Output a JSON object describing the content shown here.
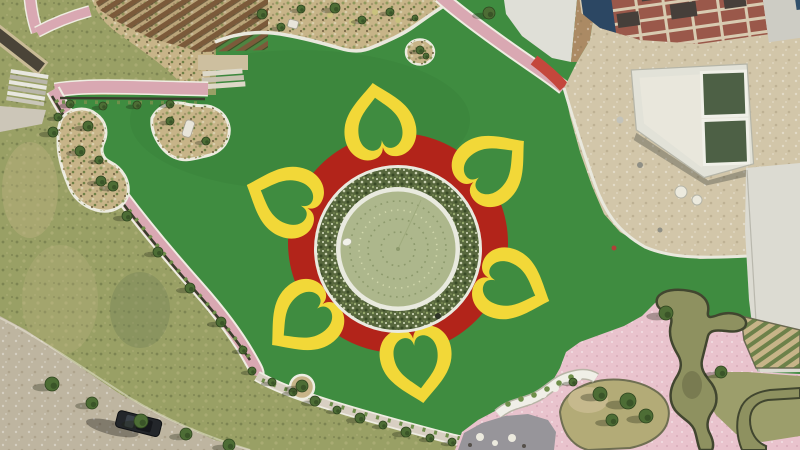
{
  "scene": {
    "title": "Aerial drone view of a park with flower-shaped fountain plaza",
    "regions": {
      "flower_plaza": "red circular plaza with six yellow heart-shaped petal outlines around a circular fountain pond with shrub ring",
      "lawn": "bright green turf lawn with organic tan planting islands",
      "construction_site": "sandy construction zone with brick-frame building and twin green water tanks (top right)",
      "water_garden": "pink paved garden with winding olive water channels and tree mound (bottom right)",
      "paths": "pink brick paths lined with hedges and young trees",
      "pergola_garden": "wooden pergola, stairs and planting beds (top left)",
      "dirt_road": "dirt service road with one parked dark car (bottom left)"
    },
    "vehicle": {
      "type": "parked car",
      "color": "dark"
    }
  },
  "colors": {
    "lawn": "#3f8c40",
    "natural_grass": "#99a065",
    "red_ring": "#b2241a",
    "petal_yellow": "#f2d838",
    "pond_rim": "#e9eadf",
    "shrub_ring_base": "#57673d",
    "water": "#adb78c",
    "water_dot": "#8c996c",
    "water_dot_light": "#d2d8ad",
    "path_pink": "#d9a8b2",
    "plaza_pink": "#e9c3cd",
    "path_red": "#c4473c",
    "path_casing": "#efede2",
    "bottom_path": "#d8cfc2",
    "sand": "#d2c6a9",
    "bed_tan": "#c7b488",
    "concrete": "#dcdbd2",
    "white_plaza": "#dfdfd7",
    "wood": "#7b5a3a",
    "brick": "#9a584a",
    "brick_beam": "#d8cbb1",
    "navy": "#2e4a66",
    "building_grey": "#cdccc4",
    "pool_green": "#4d6045",
    "channel_olive": "#8e9160",
    "channel_edge": "#41462f",
    "olive_grass": "#9c9e6b",
    "mound_tan": "#b3ab77",
    "tree_green": "#4d6d35",
    "tree_dark": "#2f451f",
    "shrub_green": "#6f8f4a",
    "hedge_dark": "#3a3d2c",
    "road_dirt": "#beb5a0",
    "car_black": "#23262a",
    "grey_paving": "#97959a",
    "white": "#f0efe7",
    "curb": "#e9e8dd",
    "bed_rows": "#5d7840",
    "brown_strip": "#ab8a64",
    "rock_white": "#e8e5da"
  },
  "flower": {
    "petal_count": 6,
    "petal_angles_deg": [
      -9,
      51,
      111,
      171,
      231,
      291
    ],
    "center": {
      "x": 398,
      "y": 243
    },
    "red_ring_radius": 110,
    "pond": {
      "center_x": 398,
      "center_y": 249,
      "outer_rim_radius": 84,
      "shrub_ring_radius": 71.5,
      "shrub_ring_width": 19,
      "water_radius": 57.5,
      "fountain_ring_radii": [
        48,
        39,
        30,
        17
      ]
    }
  },
  "vegetation": {
    "trees": [
      [
        53,
        132,
        5
      ],
      [
        58,
        117,
        4
      ],
      [
        80,
        151,
        5
      ],
      [
        101,
        181,
        5
      ],
      [
        127,
        216,
        5
      ],
      [
        158,
        252,
        5
      ],
      [
        190,
        288,
        5
      ],
      [
        221,
        322,
        5
      ],
      [
        243,
        350,
        4
      ],
      [
        70,
        104,
        4
      ],
      [
        103,
        106,
        4
      ],
      [
        137,
        105,
        4
      ],
      [
        170,
        104,
        4
      ],
      [
        252,
        371,
        4
      ],
      [
        272,
        382,
        4
      ],
      [
        293,
        392,
        4
      ],
      [
        315,
        401,
        5
      ],
      [
        337,
        410,
        4
      ],
      [
        360,
        418,
        5
      ],
      [
        383,
        425,
        4
      ],
      [
        406,
        432,
        5
      ],
      [
        430,
        438,
        4
      ],
      [
        452,
        442,
        4
      ],
      [
        52,
        384,
        7
      ],
      [
        92,
        403,
        6
      ],
      [
        141,
        421,
        7
      ],
      [
        186,
        434,
        6
      ],
      [
        229,
        445,
        6
      ],
      [
        302,
        386,
        6
      ],
      [
        489,
        13,
        6
      ],
      [
        666,
        313,
        7
      ],
      [
        721,
        372,
        6
      ],
      [
        600,
        394,
        7
      ],
      [
        628,
        401,
        8
      ],
      [
        646,
        416,
        7
      ],
      [
        612,
        420,
        6
      ],
      [
        573,
        382,
        4
      ],
      [
        88,
        126,
        5
      ],
      [
        99,
        160,
        4
      ],
      [
        113,
        186,
        5
      ],
      [
        170,
        121,
        4
      ],
      [
        206,
        141,
        4
      ],
      [
        262,
        14,
        5
      ],
      [
        281,
        27,
        4
      ],
      [
        301,
        9,
        4
      ],
      [
        335,
        8,
        5
      ],
      [
        362,
        20,
        4
      ],
      [
        390,
        12,
        4
      ],
      [
        415,
        18,
        3
      ],
      [
        420,
        50,
        4
      ],
      [
        426,
        56,
        3
      ]
    ]
  }
}
